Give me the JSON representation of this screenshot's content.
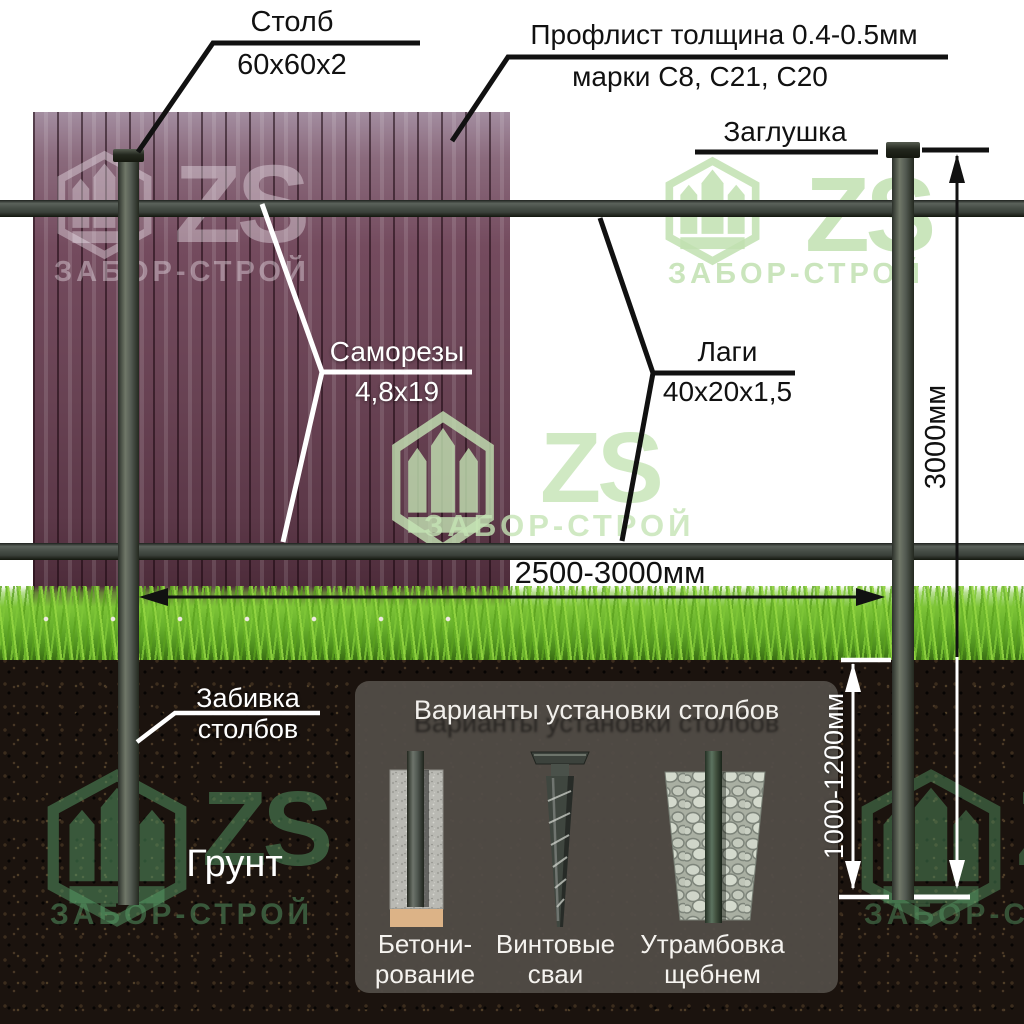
{
  "diagram": {
    "labels": {
      "post": {
        "title": "Столб",
        "size": "60х60х2"
      },
      "sheet": {
        "title": "Профлист толщина 0.4-0.5мм",
        "size": "марки С8, С21, С20"
      },
      "cap": "Заглушка",
      "screws": {
        "title": "Саморезы",
        "size": "4,8х19"
      },
      "rails": {
        "title": "Лаги",
        "size": "40х20х1,5"
      },
      "driving": {
        "line1": "Забивка",
        "line2": "столбов"
      },
      "ground": "Грунт"
    },
    "dimensions": {
      "span": "2500-3000мм",
      "post_height": "3000мм",
      "depth": "1000-1200мм"
    },
    "panel": {
      "title": "Варианты установки столбов",
      "options": [
        {
          "line1": "Бетони-",
          "line2": "рование"
        },
        {
          "line1": "Винтовые",
          "line2": "сваи"
        },
        {
          "line1": "Утрамбовка",
          "line2": "щебнем"
        }
      ]
    },
    "watermark": {
      "initials": "ZS",
      "brand": "ЗАБОР-СТРОЙ"
    },
    "colors": {
      "sheet": "#684253",
      "grass": "#68b02c",
      "soil": "#1b130e",
      "rail": "#3a403a",
      "concrete_base": "#dcb387",
      "watermark_green": "#c1e0b0"
    }
  }
}
